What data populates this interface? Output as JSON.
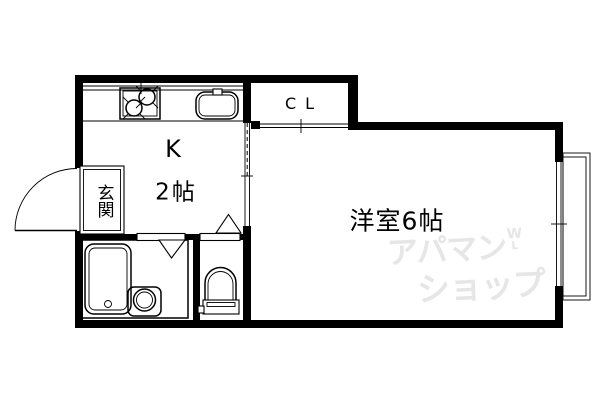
{
  "colors": {
    "background": "#ffffff",
    "line": "#000000",
    "watermark": "#e6e6e6"
  },
  "floorplan": {
    "kitchen": {
      "label": "K",
      "size": "2帖"
    },
    "western_room": {
      "label": "洋室6帖"
    },
    "closet": {
      "label": "CL"
    },
    "entrance": {
      "label": "玄関"
    }
  },
  "watermark": {
    "line1": "アパマン",
    "line2": "ショップ",
    "mark_top": "W",
    "mark_bottom": "L"
  }
}
